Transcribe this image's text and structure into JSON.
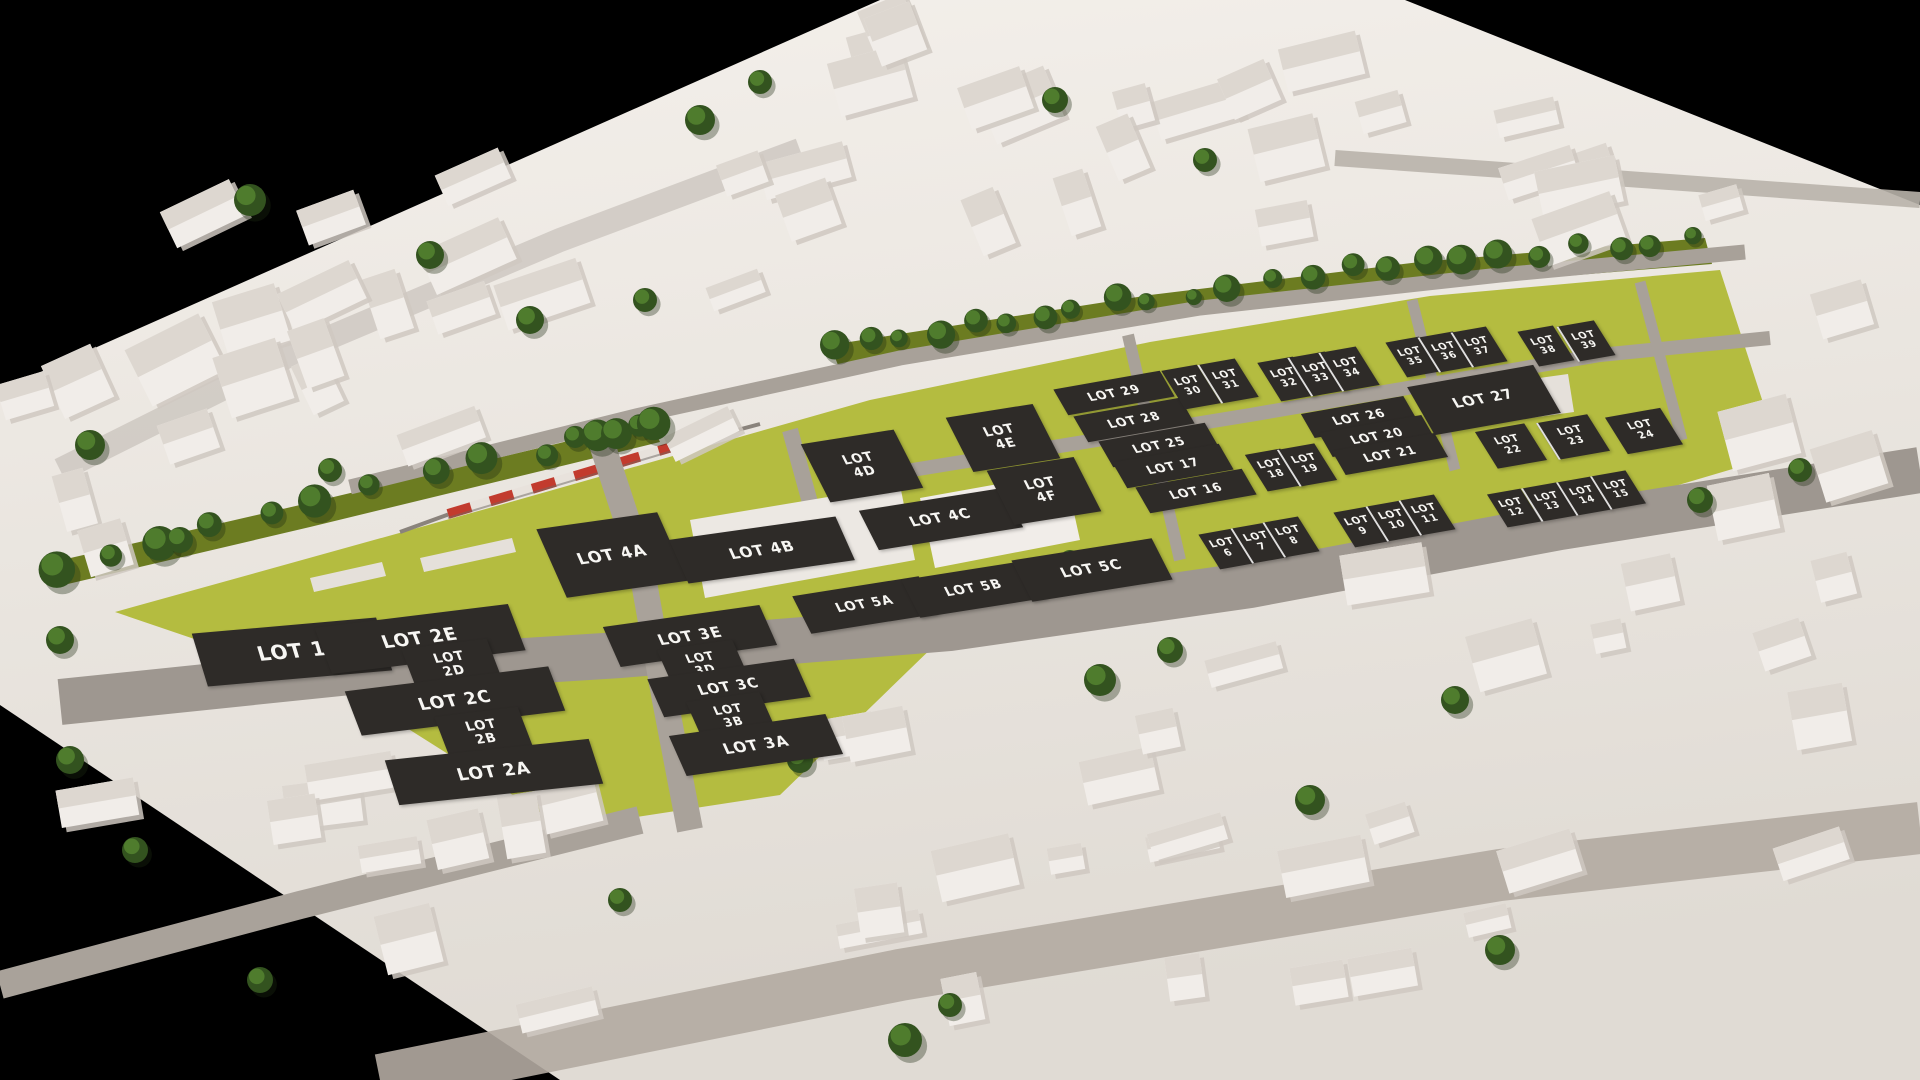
{
  "scene": {
    "description": "3D aerial render of a development masterplan: white low-poly town model on black background, yellow-green development parcels with dark lot placards, olive tree-lined park strips, grey roads and a red commuter train on a rail line",
    "colors": {
      "background": "#000000",
      "terrain_top": "#f2eee9",
      "terrain_bottom": "#e0dbd4",
      "grass": "#b4bc40",
      "park_strip": "#6c7c21",
      "road_main": "#9e9790",
      "road_minor": "#a8a199",
      "road_city": "#c2bbb3",
      "building_fill": "#f1ede9",
      "building_shade": "#ddd7d0",
      "tree_dark": "#33531f",
      "tree_light": "#4f7c2d",
      "train_red": "#c23b2e",
      "train_white": "#e8e2dc",
      "lot_label_bg": "#2e2b28",
      "lot_label_text": "#f7f6f3"
    },
    "lot_count": 54
  },
  "lots": [
    {
      "label": "LOT 1",
      "x": 292,
      "y": 652,
      "w": 185,
      "h": 54,
      "fs": 20,
      "rot": -5,
      "sk": 12
    },
    {
      "label": "LOT 2E",
      "x": 420,
      "y": 639,
      "w": 195,
      "h": 48,
      "fs": 18,
      "rot": -7,
      "sk": 14
    },
    {
      "label": "LOT 2D",
      "x": 452,
      "y": 665,
      "w": 86,
      "h": 44,
      "fs": 13,
      "rot": -7,
      "sk": 14,
      "two": true
    },
    {
      "label": "LOT 2C",
      "x": 455,
      "y": 701,
      "w": 205,
      "h": 46,
      "fs": 17,
      "rot": -7,
      "sk": 14
    },
    {
      "label": "LOT 2B",
      "x": 484,
      "y": 733,
      "w": 84,
      "h": 44,
      "fs": 13,
      "rot": -7,
      "sk": 14,
      "two": true
    },
    {
      "label": "LOT 2A",
      "x": 494,
      "y": 772,
      "w": 205,
      "h": 46,
      "fs": 17,
      "rot": -6,
      "sk": 12
    },
    {
      "label": "LOT 3E",
      "x": 690,
      "y": 636,
      "w": 158,
      "h": 42,
      "fs": 15,
      "rot": -8,
      "sk": 16
    },
    {
      "label": "LOT 3D",
      "x": 703,
      "y": 664,
      "w": 76,
      "h": 40,
      "fs": 12,
      "rot": -8,
      "sk": 16,
      "two": true
    },
    {
      "label": "LOT 3C",
      "x": 729,
      "y": 688,
      "w": 148,
      "h": 40,
      "fs": 14,
      "rot": -8,
      "sk": 16
    },
    {
      "label": "LOT 3B",
      "x": 731,
      "y": 716,
      "w": 74,
      "h": 40,
      "fs": 12,
      "rot": -8,
      "sk": 16,
      "two": true
    },
    {
      "label": "LOT 3A",
      "x": 756,
      "y": 745,
      "w": 158,
      "h": 42,
      "fs": 15,
      "rot": -8,
      "sk": 16
    },
    {
      "label": "LOT 4A",
      "x": 612,
      "y": 555,
      "w": 122,
      "h": 72,
      "fs": 16,
      "rot": -8,
      "sk": 16
    },
    {
      "label": "LOT 4B",
      "x": 762,
      "y": 550,
      "w": 168,
      "h": 46,
      "fs": 15,
      "rot": -8,
      "sk": 16
    },
    {
      "label": "LOT 4C",
      "x": 941,
      "y": 519,
      "w": 146,
      "h": 42,
      "fs": 14,
      "rot": -9,
      "sk": 18
    },
    {
      "label": "LOT 4D",
      "x": 862,
      "y": 466,
      "w": 94,
      "h": 62,
      "fs": 13,
      "rot": -9,
      "sk": 18,
      "two": true
    },
    {
      "label": "LOT 4E",
      "x": 1003,
      "y": 438,
      "w": 88,
      "h": 58,
      "fs": 13,
      "rot": -9,
      "sk": 18,
      "two": true
    },
    {
      "label": "LOT 4F",
      "x": 1044,
      "y": 491,
      "w": 88,
      "h": 58,
      "fs": 13,
      "rot": -9,
      "sk": 18,
      "two": true
    },
    {
      "label": "LOT 5A",
      "x": 865,
      "y": 605,
      "w": 128,
      "h": 40,
      "fs": 13,
      "rot": -9,
      "sk": 18
    },
    {
      "label": "LOT 5B",
      "x": 974,
      "y": 589,
      "w": 128,
      "h": 40,
      "fs": 13,
      "rot": -9,
      "sk": 18
    },
    {
      "label": "LOT 5C",
      "x": 1092,
      "y": 570,
      "w": 142,
      "h": 44,
      "fs": 14,
      "rot": -9,
      "sk": 18
    },
    {
      "label": "LOT 29",
      "x": 1114,
      "y": 393,
      "w": 108,
      "h": 28,
      "fs": 12,
      "rot": -10,
      "sk": 20
    },
    {
      "label": "LOT 28",
      "x": 1134,
      "y": 420,
      "w": 108,
      "h": 28,
      "fs": 12,
      "rot": -10,
      "sk": 20
    },
    {
      "label": "LOT 25",
      "x": 1159,
      "y": 445,
      "w": 108,
      "h": 28,
      "fs": 12,
      "rot": -10,
      "sk": 20
    },
    {
      "label": "LOT 17",
      "x": 1173,
      "y": 466,
      "w": 108,
      "h": 28,
      "fs": 12,
      "rot": -10,
      "sk": 20
    },
    {
      "label": "LOT 16",
      "x": 1196,
      "y": 491,
      "w": 108,
      "h": 28,
      "fs": 12,
      "rot": -10,
      "sk": 20
    },
    {
      "label": "LOT 30",
      "x": 1191,
      "y": 387,
      "w": 36,
      "h": 42,
      "fs": 10,
      "rot": -10,
      "sk": 22,
      "two": true
    },
    {
      "label": "LOT 31",
      "x": 1228,
      "y": 381,
      "w": 36,
      "h": 42,
      "fs": 10,
      "rot": -10,
      "sk": 22,
      "two": true,
      "div": true
    },
    {
      "label": "LOT 32",
      "x": 1287,
      "y": 379,
      "w": 36,
      "h": 42,
      "fs": 10,
      "rot": -10,
      "sk": 22,
      "two": true
    },
    {
      "label": "LOT 33",
      "x": 1318,
      "y": 374,
      "w": 36,
      "h": 42,
      "fs": 10,
      "rot": -10,
      "sk": 22,
      "two": true,
      "div": true
    },
    {
      "label": "LOT 34",
      "x": 1349,
      "y": 369,
      "w": 36,
      "h": 42,
      "fs": 10,
      "rot": -10,
      "sk": 22,
      "two": true,
      "div": true
    },
    {
      "label": "LOT 26",
      "x": 1359,
      "y": 417,
      "w": 104,
      "h": 26,
      "fs": 12,
      "rot": -10,
      "sk": 20
    },
    {
      "label": "LOT 20",
      "x": 1377,
      "y": 436,
      "w": 104,
      "h": 26,
      "fs": 12,
      "rot": -10,
      "sk": 20
    },
    {
      "label": "LOT 21",
      "x": 1390,
      "y": 454,
      "w": 104,
      "h": 26,
      "fs": 12,
      "rot": -10,
      "sk": 20
    },
    {
      "label": "LOT 18",
      "x": 1274,
      "y": 470,
      "w": 36,
      "h": 40,
      "fs": 10,
      "rot": -10,
      "sk": 22,
      "two": true
    },
    {
      "label": "LOT 19",
      "x": 1307,
      "y": 465,
      "w": 36,
      "h": 40,
      "fs": 10,
      "rot": -10,
      "sk": 22,
      "two": true,
      "div": true
    },
    {
      "label": "LOT 35",
      "x": 1413,
      "y": 357,
      "w": 34,
      "h": 38,
      "fs": 9.5,
      "rot": -10,
      "sk": 22,
      "two": true
    },
    {
      "label": "LOT 36",
      "x": 1446,
      "y": 352,
      "w": 34,
      "h": 38,
      "fs": 9.5,
      "rot": -10,
      "sk": 22,
      "two": true,
      "div": true
    },
    {
      "label": "LOT 37",
      "x": 1479,
      "y": 347,
      "w": 34,
      "h": 38,
      "fs": 9.5,
      "rot": -10,
      "sk": 22,
      "two": true,
      "div": true
    },
    {
      "label": "LOT 38",
      "x": 1546,
      "y": 346,
      "w": 36,
      "h": 38,
      "fs": 9.5,
      "rot": -10,
      "sk": 22,
      "two": true
    },
    {
      "label": "LOT 39",
      "x": 1586,
      "y": 341,
      "w": 36,
      "h": 38,
      "fs": 9.5,
      "rot": -10,
      "sk": 22,
      "two": true,
      "div": true
    },
    {
      "label": "LOT 27",
      "x": 1484,
      "y": 400,
      "w": 128,
      "h": 52,
      "fs": 14,
      "rot": -10,
      "sk": 20
    },
    {
      "label": "LOT 22",
      "x": 1511,
      "y": 446,
      "w": 50,
      "h": 40,
      "fs": 10,
      "rot": -10,
      "sk": 22,
      "two": true
    },
    {
      "label": "LOT 23",
      "x": 1573,
      "y": 437,
      "w": 50,
      "h": 40,
      "fs": 10,
      "rot": -10,
      "sk": 22,
      "two": true,
      "div": true
    },
    {
      "label": "LOT 24",
      "x": 1644,
      "y": 431,
      "w": 56,
      "h": 40,
      "fs": 10,
      "rot": -10,
      "sk": 22,
      "two": true
    },
    {
      "label": "LOT 6",
      "x": 1226,
      "y": 549,
      "w": 34,
      "h": 38,
      "fs": 10,
      "rot": -10,
      "sk": 22,
      "two": true
    },
    {
      "label": "LOT 7",
      "x": 1259,
      "y": 543,
      "w": 34,
      "h": 38,
      "fs": 10,
      "rot": -10,
      "sk": 22,
      "two": true,
      "div": true
    },
    {
      "label": "LOT 8",
      "x": 1291,
      "y": 537,
      "w": 34,
      "h": 38,
      "fs": 10,
      "rot": -10,
      "sk": 22,
      "two": true,
      "div": true
    },
    {
      "label": "LOT 9",
      "x": 1361,
      "y": 527,
      "w": 34,
      "h": 38,
      "fs": 10,
      "rot": -10,
      "sk": 22,
      "two": true
    },
    {
      "label": "LOT 10",
      "x": 1394,
      "y": 521,
      "w": 34,
      "h": 38,
      "fs": 10,
      "rot": -10,
      "sk": 22,
      "two": true,
      "div": true
    },
    {
      "label": "LOT 11",
      "x": 1427,
      "y": 515,
      "w": 34,
      "h": 38,
      "fs": 10,
      "rot": -10,
      "sk": 22,
      "two": true,
      "div": true
    },
    {
      "label": "LOT 12",
      "x": 1514,
      "y": 508,
      "w": 34,
      "h": 36,
      "fs": 9.5,
      "rot": -10,
      "sk": 22,
      "two": true
    },
    {
      "label": "LOT 13",
      "x": 1549,
      "y": 502,
      "w": 34,
      "h": 36,
      "fs": 9.5,
      "rot": -10,
      "sk": 22,
      "two": true,
      "div": true
    },
    {
      "label": "LOT 14",
      "x": 1584,
      "y": 496,
      "w": 34,
      "h": 36,
      "fs": 9.5,
      "rot": -10,
      "sk": 22,
      "two": true,
      "div": true
    },
    {
      "label": "LOT 15",
      "x": 1618,
      "y": 490,
      "w": 34,
      "h": 36,
      "fs": 9.5,
      "rot": -10,
      "sk": 22,
      "two": true,
      "div": true
    }
  ]
}
